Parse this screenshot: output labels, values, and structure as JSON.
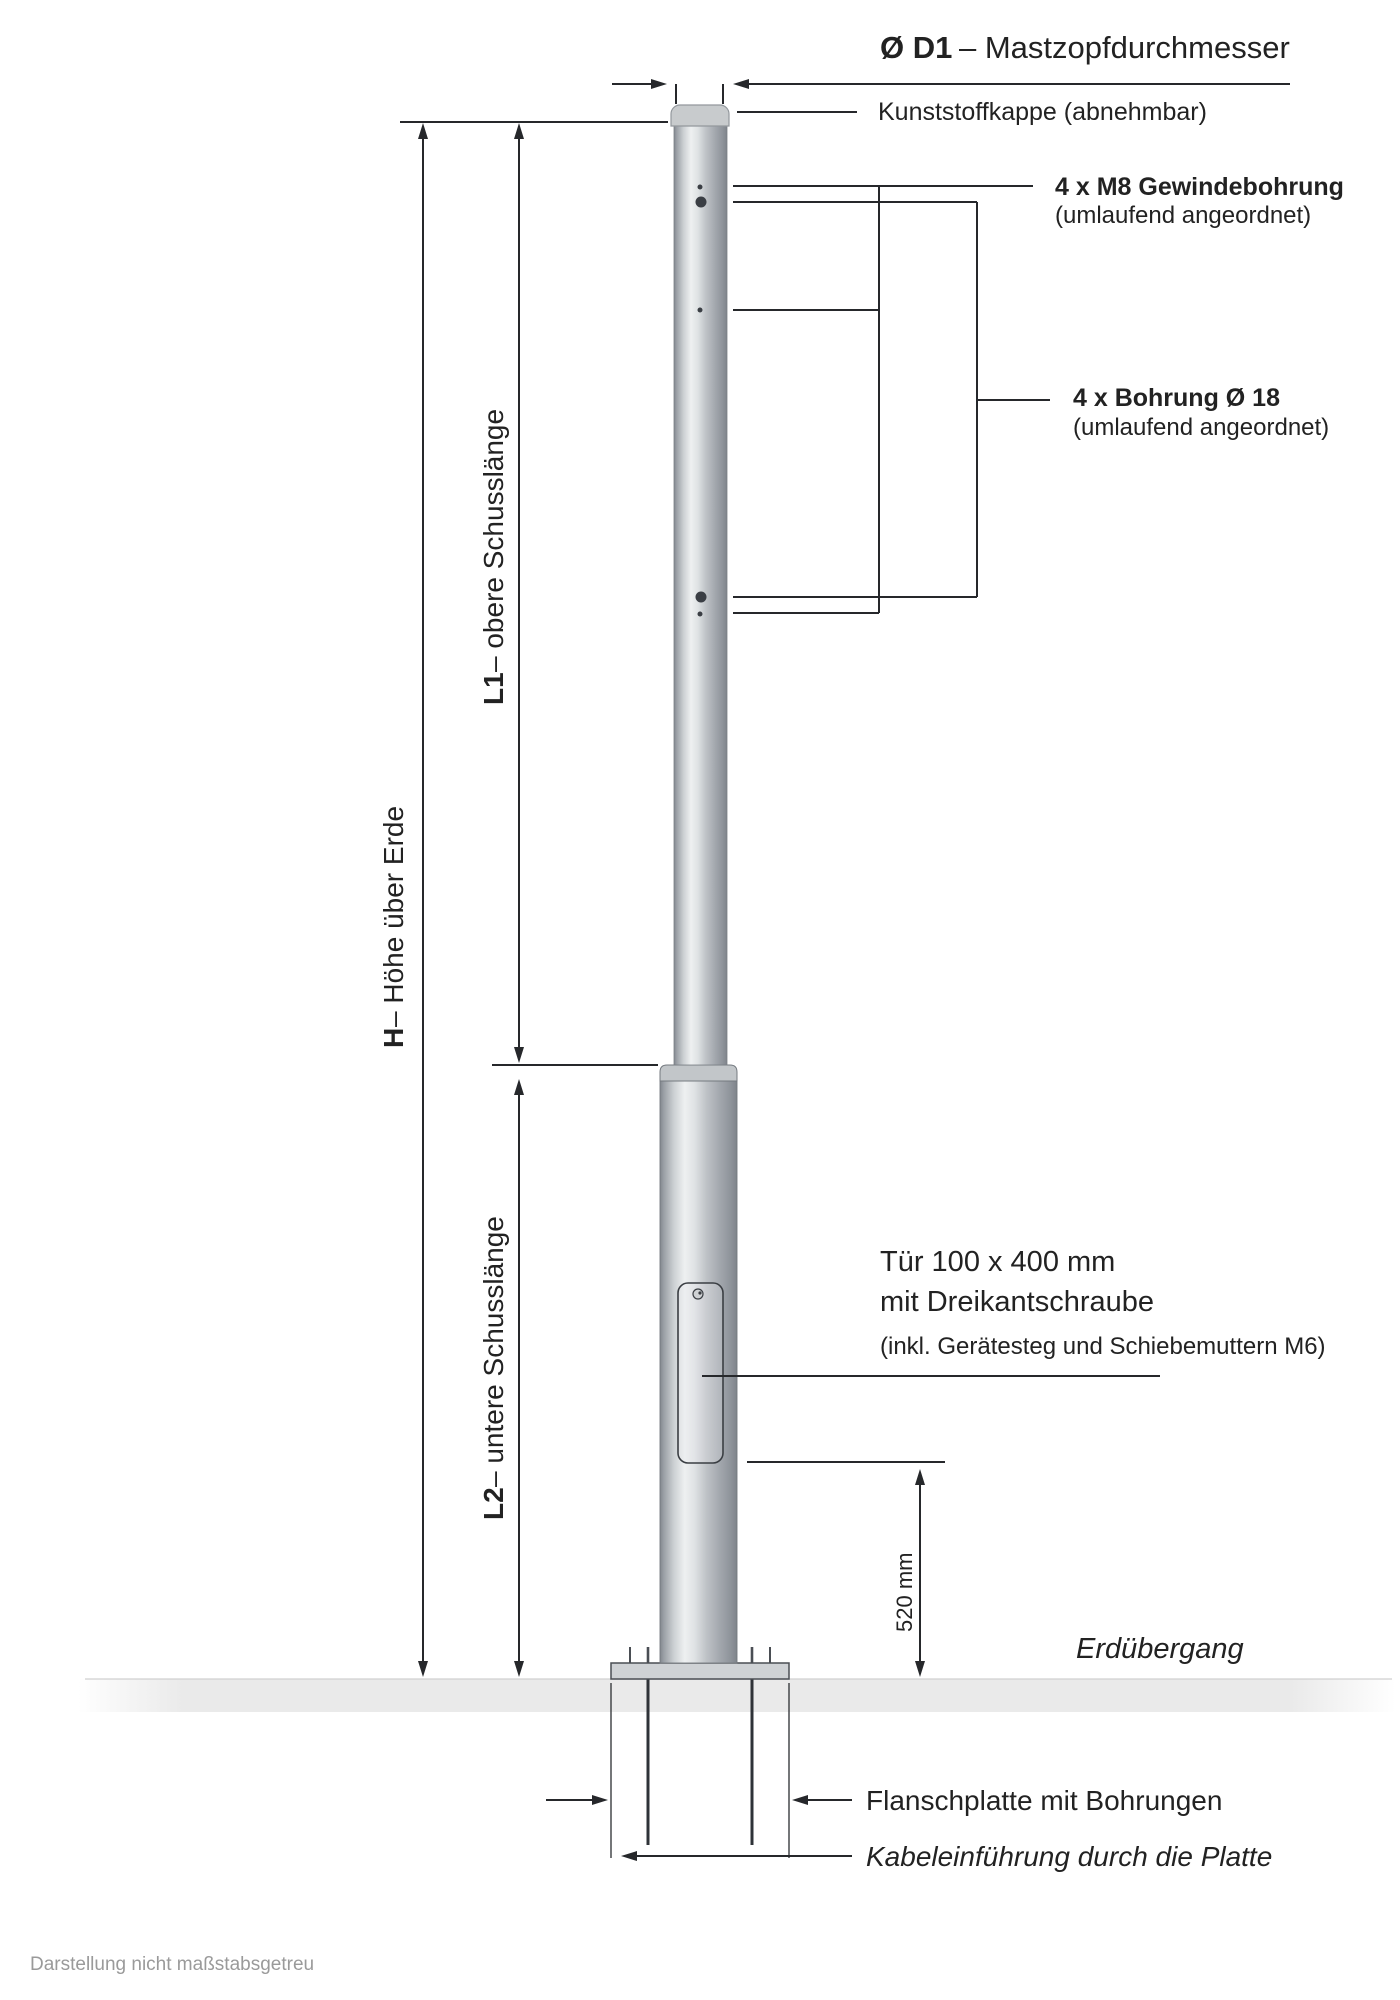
{
  "title": {
    "bold": "Ø D1",
    "rest": " – Mastzopfdurchmesser"
  },
  "labels": {
    "cap": "Kunststoffkappe (abnehmbar)",
    "m8": {
      "title": "4 x M8 Gewindebohrung",
      "sub": "(umlaufend angeordnet)"
    },
    "bore": {
      "title": "4 x Bohrung Ø 18",
      "sub": "(umlaufend angeordnet)"
    },
    "door": {
      "line1": "Tür 100 x 400 mm",
      "line2": "mit Dreikantschraube",
      "line3": "(inkl. Gerätesteg und Schiebemuttern M6)"
    },
    "ground_transition": "Erdübergang",
    "flange": "Flanschplatte mit Bohrungen",
    "cable": "Kabeleinführung durch die Platte"
  },
  "dimensions": {
    "h": {
      "bold": "H",
      "rest": " – Höhe über Erde"
    },
    "l1": {
      "bold": "L1",
      "rest": " – obere Schusslänge"
    },
    "l2": {
      "bold": "L2",
      "rest": " – untere Schusslänge"
    },
    "door_offset": "520 mm"
  },
  "footnote": "Darstellung nicht maßstabsgetreu",
  "colors": {
    "line": "#26282b",
    "text": "#222222",
    "muted_text": "#9a9a9a",
    "metal_light": "#eff0f1",
    "metal_dark": "#82878e",
    "ground": "#eaeaea"
  }
}
